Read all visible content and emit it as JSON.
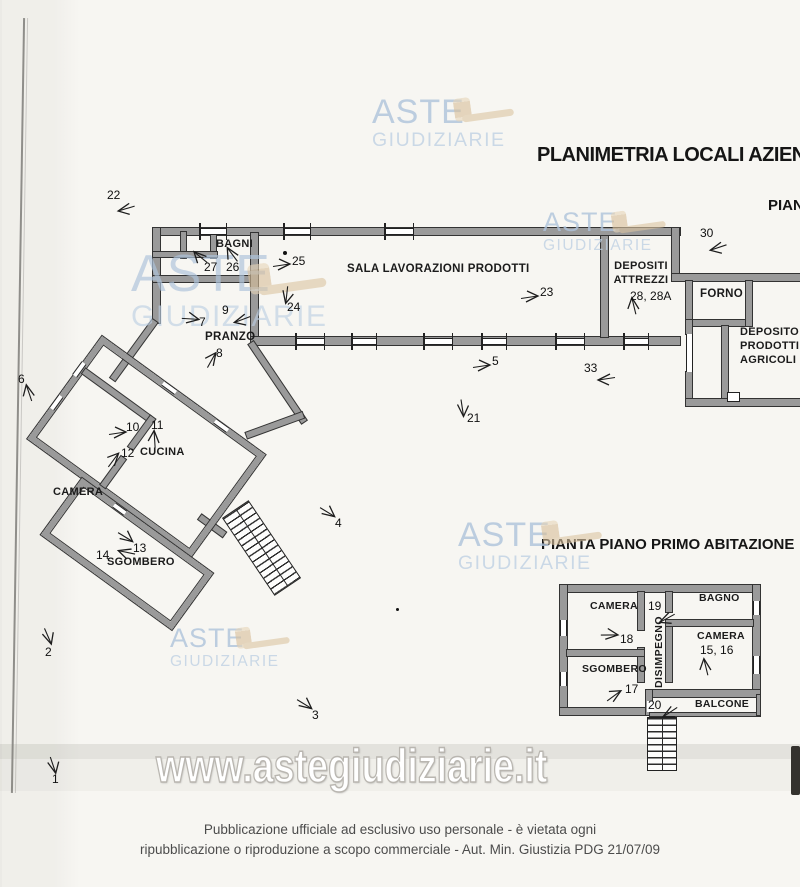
{
  "titles": {
    "main": "PLANIMETRIA LOCALI AZIEN",
    "top_right_partial": "PIAN",
    "first_floor": "PIANTA PIANO PRIMO ABITAZIONE"
  },
  "watermark": {
    "aste": "ASTE",
    "giudiziarie": "GIUDIZIARIE",
    "url": "www.astegiudiziarie.it",
    "colors": {
      "logo_blue": "#aec3db",
      "gavel_tan": "#dcc5a2"
    }
  },
  "ground_floor": {
    "rooms": {
      "bagni": "BAGNI",
      "sala": "SALA LAVORAZIONI PRODOTTI",
      "depositi_l1": "DEPOSITI",
      "depositi_l2": "ATTREZZI",
      "forno": "FORNO",
      "deposito_l1": "DEPOSITO",
      "deposito_l2": "PRODOTTI",
      "deposito_l3": "AGRICOLI",
      "pranzo": "PRANZO",
      "cucina": "CUCINA",
      "camera": "CAMERA",
      "sgombero": "SGOMBERO"
    }
  },
  "first_floor": {
    "rooms": {
      "camera_nw": "CAMERA",
      "bagno": "BAGNO",
      "disimpegno": "DISIMPEGNO",
      "camera_e": "CAMERA",
      "sgombero": "SGOMBERO",
      "balcone": "BALCONE"
    }
  },
  "footer": {
    "line1": "Pubblicazione ufficiale ad esclusivo uso personale - è vietata ogni",
    "line2": "ripubblicazione o riproduzione a scopo commerciale - Aut. Min. Giustizia PDG 21/07/09"
  },
  "markers": [
    {
      "label": "22",
      "nx": 107,
      "ny": 188,
      "ax": 114,
      "ay": 202,
      "rot": -8
    },
    {
      "label": "30",
      "nx": 700,
      "ny": 226,
      "ax": 706,
      "ay": 241,
      "rot": -10
    },
    {
      "label": "27",
      "nx": 204,
      "ny": 260,
      "ax": 188,
      "ay": 249,
      "rot": 48
    },
    {
      "label": "26",
      "nx": 226,
      "ny": 260,
      "ax": 220,
      "ay": 246,
      "rot": 62
    },
    {
      "label": "25",
      "nx": 292,
      "ny": 254,
      "ax": 272,
      "ay": 257,
      "rot": 180
    },
    {
      "label": "24",
      "nx": 287,
      "ny": 300,
      "ax": 276,
      "ay": 289,
      "rot": -75
    },
    {
      "label": "23",
      "nx": 540,
      "ny": 285,
      "ax": 520,
      "ay": 289,
      "rot": 180
    },
    {
      "label": "9",
      "nx": 222,
      "ny": 303,
      "ax": 230,
      "ay": 313,
      "rot": -12
    },
    {
      "label": "7",
      "nx": 199,
      "ny": 315,
      "ax": 181,
      "ay": 311,
      "rot": 192
    },
    {
      "label": "8",
      "nx": 216,
      "ny": 346,
      "ax": 201,
      "ay": 351,
      "rot": 128
    },
    {
      "label": "6",
      "nx": 18,
      "ny": 372,
      "ax": 17,
      "ay": 384,
      "rot": 80
    },
    {
      "label": "10",
      "nx": 126,
      "ny": 420,
      "ax": 108,
      "ay": 425,
      "rot": 180
    },
    {
      "label": "11",
      "nx": 151,
      "ny": 418,
      "ax": 143,
      "ay": 430,
      "rot": 95
    },
    {
      "label": "12",
      "nx": 121,
      "ny": 446,
      "ax": 103,
      "ay": 451,
      "rot": 135
    },
    {
      "label": "5",
      "nx": 492,
      "ny": 354,
      "ax": 472,
      "ay": 358,
      "rot": 180
    },
    {
      "label": "33",
      "nx": 584,
      "ny": 361,
      "ax": 594,
      "ay": 372,
      "rot": 0
    },
    {
      "label": "21",
      "nx": 467,
      "ny": 411,
      "ax": 452,
      "ay": 402,
      "rot": -90
    },
    {
      "label": "4",
      "nx": 335,
      "ny": 516,
      "ax": 318,
      "ay": 505,
      "rot": -140
    },
    {
      "label": "13",
      "nx": 133,
      "ny": 541,
      "ax": 116,
      "ay": 530,
      "rot": -140
    },
    {
      "label": "14",
      "nx": 96,
      "ny": 548,
      "ax": 114,
      "ay": 545,
      "rot": 20
    },
    {
      "label": "2",
      "nx": 45,
      "ny": 645,
      "ax": 38,
      "ay": 630,
      "rot": -105
    },
    {
      "label": "3",
      "nx": 312,
      "ny": 708,
      "ax": 295,
      "ay": 697,
      "rot": -140
    },
    {
      "label": "1",
      "nx": 52,
      "ny": 772,
      "ax": 43,
      "ay": 759,
      "rot": -100
    },
    {
      "label": "18",
      "nx": 620,
      "ny": 632,
      "ax": 600,
      "ay": 627,
      "rot": 188
    },
    {
      "label": "19",
      "nx": 648,
      "ny": 599,
      "ax": 655,
      "ay": 612,
      "rot": -20
    },
    {
      "label": "17",
      "nx": 625,
      "ny": 682,
      "ax": 604,
      "ay": 687,
      "rot": 152
    },
    {
      "label": "20",
      "nx": 648,
      "ny": 698,
      "ax": 658,
      "ay": 706,
      "rot": -25
    },
    {
      "label": "15, 16",
      "nx": 700,
      "ny": 643,
      "ax": 694,
      "ay": 658,
      "rot": 85
    },
    {
      "label": "28, 28A",
      "nx": 630,
      "ny": 289,
      "ax": 622,
      "ay": 297,
      "rot": 85
    }
  ]
}
